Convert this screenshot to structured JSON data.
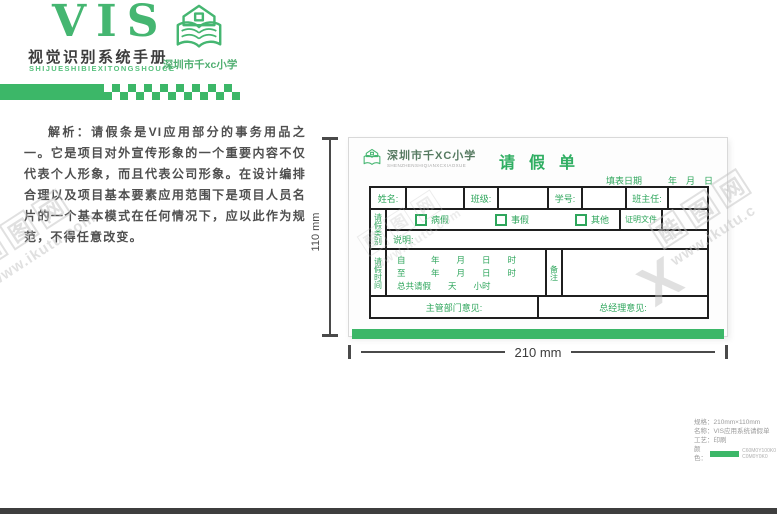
{
  "colors": {
    "brand_green": "#3cb768",
    "table_border": "#1f1f1f",
    "watermark_gray": "#c3c3c3"
  },
  "header": {
    "vis": "VIS",
    "manual_title": "视觉识别系统手册",
    "manual_title_en": "SHIJUESHIBIEXITONGSHOUCE",
    "school_name": "深圳市千xc小学"
  },
  "analysis": {
    "text": "解析：请假条是VI应用部分的事务用品之一。它是项目对外宣传形象的一个重要内容不仅代表个人形象，而且代表公司形象。在设计编排合理以及项目基本要素应用范围下是项目人员名片的一个基本模式在任何情况下，应以此作为规范，不得任意改变。"
  },
  "form": {
    "school_name": "深圳市千XC小学",
    "school_name_en": "SHENZHENSHIQIANXCXIAOXUE",
    "title": "请假单",
    "date_label": "填表日期",
    "date_value": "年　月　日",
    "row1": {
      "name_label": "姓名:",
      "class_label": "班级:",
      "number_label": "学号:",
      "teacher_label": "班主任:"
    },
    "leave_type": {
      "section_label": "请假类别",
      "options": [
        "病假",
        "事假",
        "其他"
      ],
      "proof_label": "证明文件",
      "note_label": "说明:"
    },
    "leave_time": {
      "section_label": "请假时间",
      "line_from": "自　　　年　　月　　日　　时",
      "line_to": "至　　　年　　月　　日　　时",
      "line_total": "总共请假　　天　　小时",
      "remark_label": "备注"
    },
    "opinions": {
      "dept_label": "主管部门意见:",
      "manager_label": "总经理意见:"
    }
  },
  "dimensions": {
    "width_label": "210 mm",
    "height_label": "110 mm"
  },
  "spec": {
    "size": "规格：210mm×110mm",
    "name": "名称：VIS应用系统请假单",
    "craft": "工艺：印刷",
    "color_label": "颜色：",
    "color_values": [
      "C60M0Y100K0",
      "C0M0Y0K0"
    ]
  },
  "watermark": {
    "brand_chars": [
      "酷",
      "图",
      "网"
    ],
    "url": "www.ikutu.com",
    "url_short": "www.ikutu.c",
    "x": "X"
  }
}
